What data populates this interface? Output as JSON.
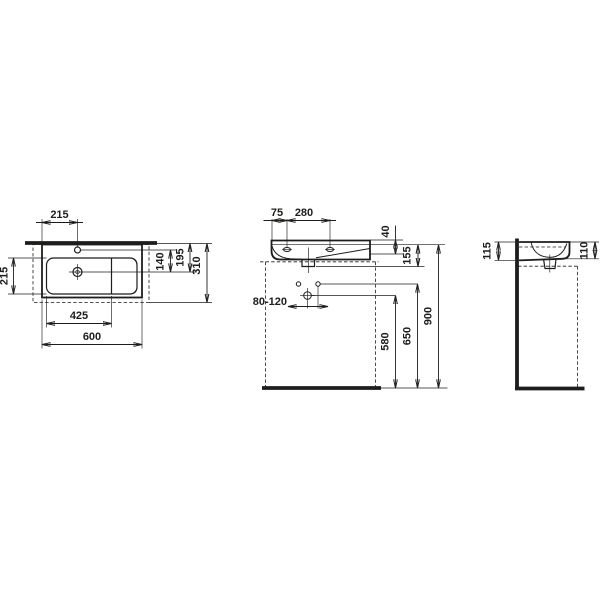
{
  "meta": {
    "background_color": "#ffffff",
    "line_color": "#1d1d1b",
    "drawing_type": "washbasin dimension drawing, three orthographic views"
  },
  "plan_view": {
    "tap_hole_offset": "215",
    "bowl_depth": "215",
    "tap_axis_to_drain": "140",
    "rim_to_drain": "195",
    "total_depth": "310",
    "bowl_width": "425",
    "total_width": "600"
  },
  "front_view": {
    "edge_to_first_hole": "75",
    "hole_spacing": "280",
    "rim_to_shelf": "40",
    "basin_height": "155",
    "trap_offset_range": "80-120",
    "trap_height": "580",
    "fixing_height": "650",
    "rim_height": "900"
  },
  "side_view": {
    "back_height": "115",
    "front_height": "110"
  }
}
